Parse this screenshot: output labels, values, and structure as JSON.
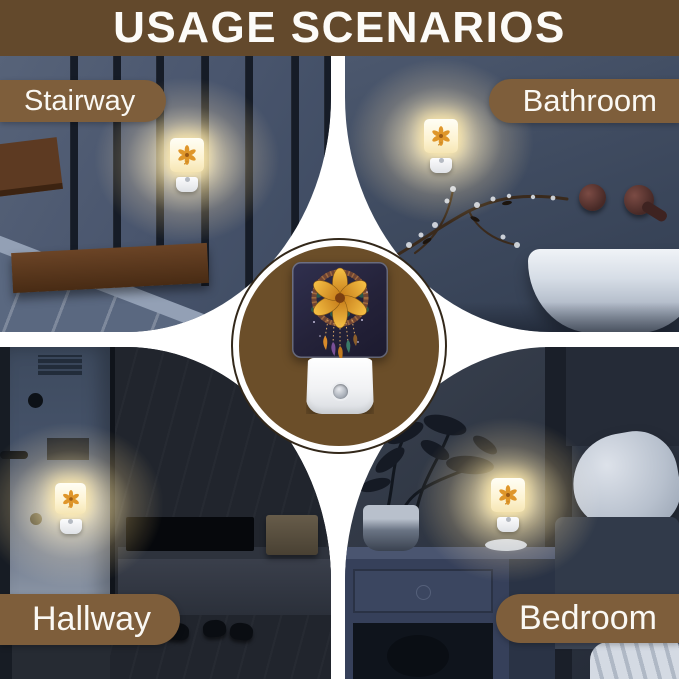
{
  "header": {
    "title": "USAGE SCENARIOS",
    "background_color": "#63492C",
    "text_color": "#FFFFFF"
  },
  "scenes": {
    "stairway": {
      "label": "Stairway"
    },
    "bathroom": {
      "label": "Bathroom"
    },
    "hallway": {
      "label": "Hallway"
    },
    "bedroom": {
      "label": "Bedroom"
    }
  },
  "label_pill": {
    "background_color": "#7E5E3B",
    "text_color": "#FAF8F3"
  },
  "medallion": {
    "disc_color": "#6B4E29",
    "ring_color": "#33281A"
  },
  "product": {
    "type": "plug-in night light with light sensor",
    "artwork": "dreamcatcher with orange lily flower and hanging feathers",
    "glow_color": "#FFE6A6"
  }
}
